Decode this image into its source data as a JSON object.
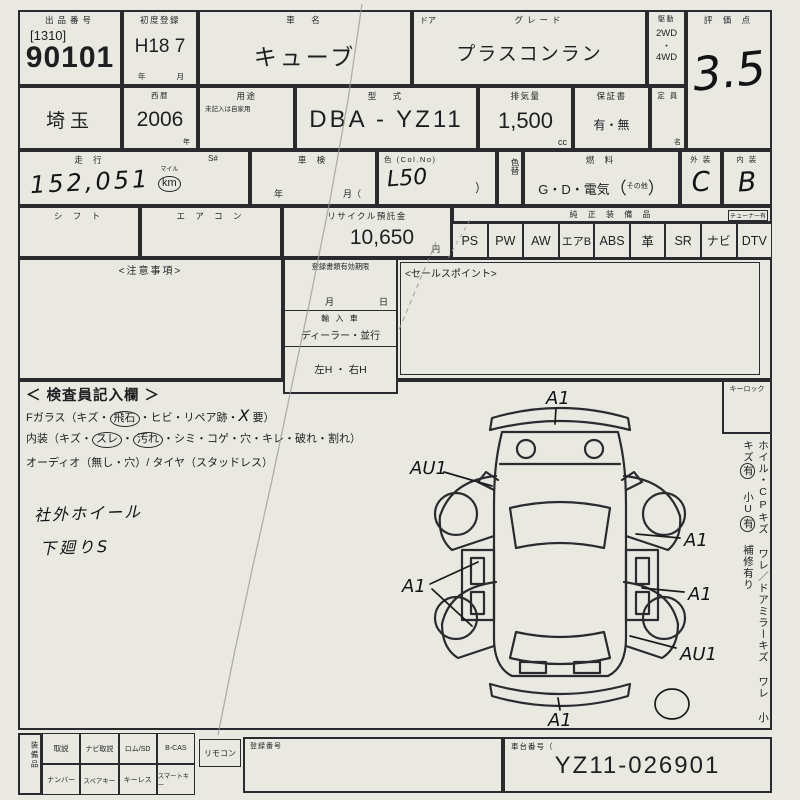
{
  "palette": {
    "paper": "#e9e9e2",
    "ink": "#1f1f22",
    "handwriting": "#131316",
    "artifact": "#9a9a93"
  },
  "header": {
    "lot_label": "出品番号",
    "lot_bracket": "[1310]",
    "lot_number": "90101",
    "first_reg_label": "初度登録",
    "first_reg_value": "H18 7",
    "first_reg_unit_year": "年",
    "first_reg_unit_month": "月",
    "name_label": "車　名",
    "name_value": "キューブ",
    "door_label": "ドア",
    "grade_label": "グレード",
    "grade_value": "プラスコンラン",
    "drive_label": "駆動",
    "drive_top": "2WD",
    "drive_sep": "・",
    "drive_bottom": "4WD",
    "score_label": "評 価 点",
    "score_value": "3.5"
  },
  "registration": {
    "region_value": "埼玉",
    "western_label": "西暦",
    "western_value": "2006",
    "western_unit": "年",
    "usage_label": "用途",
    "usage_note": "未記入は自家用",
    "model_label": "型　式",
    "model_value": "DBA - YZ11",
    "displacement_label": "排気量",
    "displacement_value": "1,500",
    "displacement_unit": "cc",
    "warranty_label": "保証書",
    "warranty_value": "有・無",
    "capacity_label": "定 員",
    "capacity_unit": "名"
  },
  "condition": {
    "mileage_label": "走  行",
    "s_label": "S#",
    "mileage_value": "152,051",
    "mile_unit": "マイル",
    "km_unit": "km",
    "shaken_label": "車  検",
    "shaken_year": "年",
    "shaken_month": "月（",
    "color_label": "色 (Col.No)",
    "color_value": "L50",
    "color_close": "）",
    "color_change_label": "色替",
    "fuel_label": "燃  料",
    "fuel_value": "G・D・電気",
    "fuel_open": "（",
    "fuel_other": "その他",
    "fuel_close": "）",
    "exterior_label": "外 装",
    "exterior_value": "C",
    "interior_label": "内 装",
    "interior_value": "B"
  },
  "equipment": {
    "shift_label": "シ フ ト",
    "aircon_label": "エ ア コ ン",
    "recycle_label": "リサイクル預託金",
    "recycle_value": "10,650",
    "recycle_unit": "円",
    "genuine_label": "純 正 装 備 品",
    "tuner_note": "チューナー有",
    "items": [
      "PS",
      "PW",
      "AW",
      "エアB",
      "ABS",
      "革",
      "SR",
      "ナビ",
      "DTV"
    ]
  },
  "notices": {
    "caution_label": "<注意事項>",
    "sales_label": "<セールスポイント>",
    "docs_label": "登録書類有効期限",
    "docs_month": "月",
    "docs_day": "日",
    "import_label": "輸 入 車",
    "import_value": "ディーラー・並行",
    "handle_value": "左H ・ 右H"
  },
  "inspection": {
    "title": "＜ 検査員記入欄 ＞",
    "fglass_pre": "Fガラス（キズ・",
    "fglass_circled": "飛石",
    "fglass_mid": "・ヒビ・リペア跡・",
    "fglass_mark": "X",
    "fglass_post": "要）",
    "interior_pre": "内装（キズ・",
    "interior_c1": "スレ",
    "interior_sep": "・",
    "interior_c2": "汚れ",
    "interior_post": "・シミ・コゲ・穴・キレ・破れ・割れ）",
    "audio_line": "オーディオ（無し・穴）/ タイヤ（スタッドレス）",
    "note1": "社外ホイール",
    "note2": "下廻りS",
    "keylock_label": "キーロック",
    "side_text1": "ホイル・CPキズ ワレ",
    "side_slash": "／",
    "side_text2": "ドアミラーキズ ワレ",
    "side_small1": "小キズ",
    "side_small1_mark": "有",
    "side_small2": "小U",
    "side_small2_mark": "有",
    "side_repair": "補修有り",
    "diagram": {
      "front": "A1",
      "left_fender": "AU1",
      "left_doors": "A1",
      "right_front_door": "A1",
      "right_rear_door": "A1",
      "right_rear_fender": "AU1",
      "rear": "A1"
    }
  },
  "bottom": {
    "accessories_label": "装備品",
    "row1": [
      "取説",
      "ナビ取説",
      "ロム/SD",
      "B-CAS"
    ],
    "row2": [
      "ナンバー",
      "スペアキー",
      "キーレス",
      "スマートキー"
    ],
    "remote_label": "リモコン",
    "registration_label": "登録番号",
    "chassis_label": "車台番号（",
    "chassis_value": "YZ11-026901"
  }
}
